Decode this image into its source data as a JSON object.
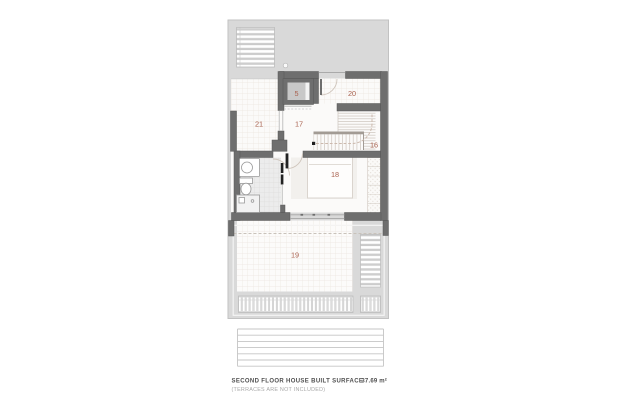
{
  "plan": {
    "room_labels": {
      "r5": "5",
      "r16": "16",
      "r17": "17",
      "r18": "18",
      "r19": "19",
      "r20": "20",
      "r21": "21"
    }
  },
  "footer": {
    "title": "SECOND FLOOR HOUSE BUILT SURFACE",
    "note": "(TERRACES ARE NOT INCLUDED)",
    "area": "37.69 m²"
  },
  "colors": {
    "wall": "#6e6e6e",
    "backdrop": "#d9d9d9",
    "room_label": "#a9614f",
    "text_primary": "#4f4f4f",
    "text_muted": "#a8a8a8"
  }
}
